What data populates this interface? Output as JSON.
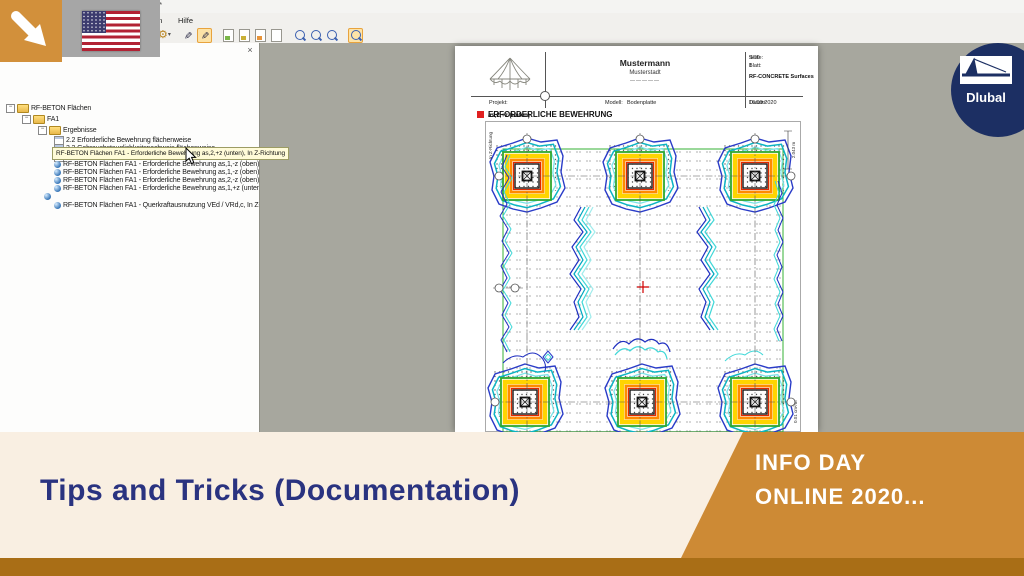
{
  "colors": {
    "accent_orange": "#D2903B",
    "strip_brown": "#A96E16",
    "cream": "#F9EFE2",
    "navy_text": "#2A3380",
    "dlubal_navy": "#1C2F63",
    "preview_gray": "#A7A79E",
    "tooltip_yellow": "#FFFBD8"
  },
  "window": {
    "title_fragment": "se*",
    "menu": [
      "en",
      "Hilfe"
    ],
    "panel_close": "×",
    "toolbar_icons": [
      "gear-icon",
      "pointer-pen-icon",
      "select-pen-icon",
      "report-doc-icons",
      "zoom-icons"
    ]
  },
  "tree": {
    "items": [
      {
        "label": "RF-BETON Flächen"
      },
      {
        "label": "FA1"
      },
      {
        "label": "Ergebnisse"
      },
      {
        "label": "2.2 Erforderliche Bewehrung flächenweise"
      },
      {
        "label": "3.2 Gebrauchstauglichkeitsnachweis flächenweise"
      },
      {
        "label": "Gebrauchstauglichkeitsnachweis Anmerkung"
      },
      {
        "label": "RF-BETON Flächen FA1 - Erforderliche Bewehrung as,1,-z (oben), In Z-"
      },
      {
        "label": "RF-BETON Flächen FA1 - Erforderliche Bewehrung as,1,-z (oben), In Z-"
      },
      {
        "label": "RF-BETON Flächen FA1 - Erforderliche Bewehrung as,2,-z (oben), In Z-"
      },
      {
        "label": "RF-BETON Flächen FA1 - Erforderliche Bewehrung as,1,+z (unten), In Z"
      },
      {
        "label": "RF-BETON Flächen FA1 - Querkraftausnutzung VEd / VRd,c, In Z-Rich"
      }
    ],
    "tooltip": "RF-BETON Flächen FA1 - Erforderliche Bewehrung as,2,+z (unten), In Z-Richtung"
  },
  "report": {
    "company": "Mustermann",
    "city": "Musterstadt",
    "divider": "―――――",
    "page_label": "Seite:",
    "page_value": "9/10",
    "sheet_label": "Blatt:",
    "sheet_value": "1",
    "module": "RF-CONCRETE Surfaces",
    "project_label": "Projekt:",
    "model_label": "Modell:",
    "model_value": "Bodenplatte",
    "date_label": "Datum:",
    "date_value": "16.09.2020",
    "section_title": "ERFORDERLICHE BEWEHRUNG",
    "section_sub": "as,2,+z (unten)",
    "drawing": {
      "direction_label": "In Z-Richtung",
      "dimension": "2.043 m",
      "unit": "0.01 cm²/m"
    }
  },
  "banner": {
    "title": "Tips and Tricks (Documentation)",
    "event_line1": "INFO DAY",
    "event_line2": "ONLINE 2020...",
    "logo_text": "Dlubal"
  }
}
